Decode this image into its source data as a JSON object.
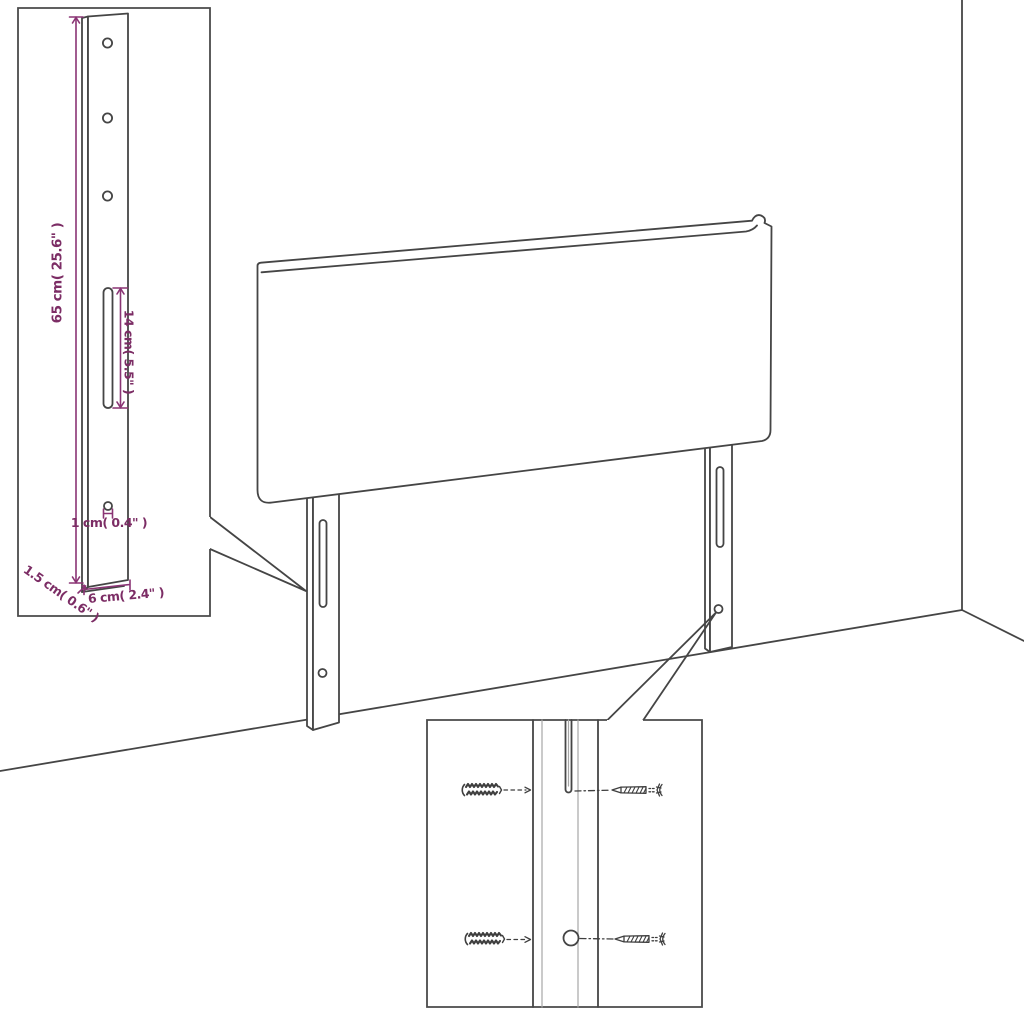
{
  "canvas": {
    "width": 1024,
    "height": 1024,
    "background": "#ffffff"
  },
  "colors": {
    "line": "#454545",
    "line_light": "#a6a6a6",
    "dimension_text": "#7c2d65",
    "dimension_line": "#8a3474"
  },
  "drawing": {
    "type": "furniture assembly diagram",
    "subject": "upholstered headboard with two mounting legs, shown against a room corner"
  },
  "leg_detail_inset": {
    "description": "enlarged front view of one mounting leg",
    "labels": {
      "height": "65 cm( 25.6\" )",
      "slot_height": "14 cm( 5.5\" )",
      "hole_diameter": "1 cm( 0.4\" )",
      "thickness": "1.5 cm( 0.6\" )",
      "width": "6 cm( 2.4\" )"
    },
    "features": [
      "three round holes",
      "vertical slot",
      "small round hole"
    ]
  },
  "mounting_detail_inset": {
    "description": "close-up of leg slot and hole with wall plugs and screws",
    "icons": [
      "wall-plug-icon",
      "wall-plug-icon",
      "screw-icon",
      "screw-icon"
    ],
    "features": [
      "slot",
      "round hole",
      "dashed alignment lines"
    ]
  }
}
